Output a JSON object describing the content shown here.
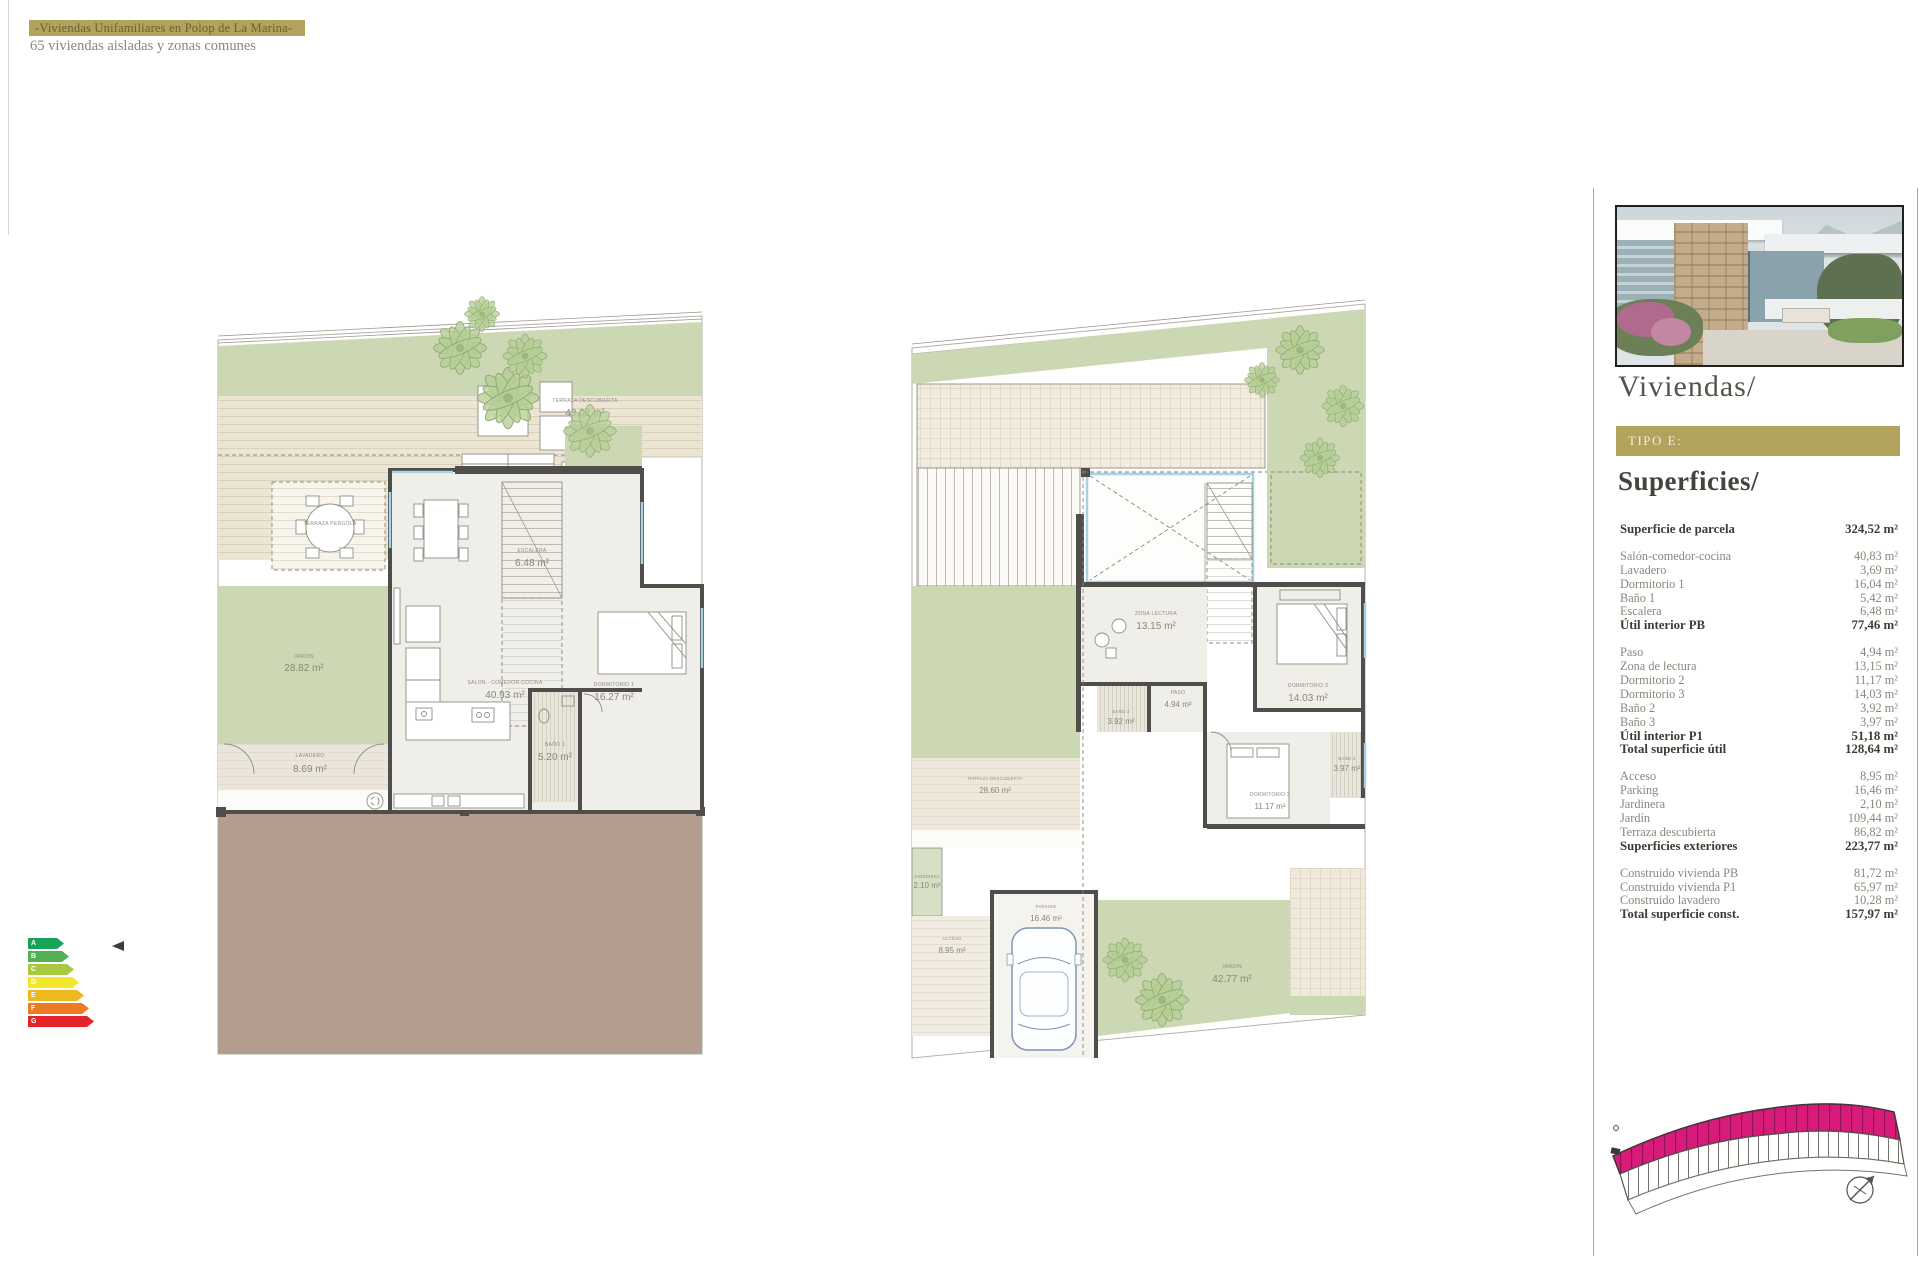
{
  "header": {
    "title": "-Viviendas Unifamiliares en Polop de La Marina-",
    "subtitle": "65 viviendas aisladas y zonas comunes"
  },
  "sidebar": {
    "project_title": "Viviendas/",
    "type_label": "TIPO E:",
    "section_title": "Superficies/"
  },
  "surfaces": {
    "sections": [
      {
        "rows": [
          {
            "label": "Superficie de parcela",
            "value": "324,52 m²",
            "bold": true
          }
        ]
      },
      {
        "rows": [
          {
            "label": "Salón-comedor-cocina",
            "value": "40,83 m²"
          },
          {
            "label": "Lavadero",
            "value": "3,69 m²"
          },
          {
            "label": "Dormitorio 1",
            "value": "16,04 m²"
          },
          {
            "label": "Baño 1",
            "value": "5,42 m²"
          },
          {
            "label": "Escalera",
            "value": "6,48 m²"
          },
          {
            "label": "Útil interior PB",
            "value": "77,46 m²",
            "bold": true
          }
        ]
      },
      {
        "rows": [
          {
            "label": "Paso",
            "value": "4,94 m²"
          },
          {
            "label": "Zona de lectura",
            "value": "13,15 m²"
          },
          {
            "label": "Dormitorio 2",
            "value": "11,17 m²"
          },
          {
            "label": "Dormitorio 3",
            "value": "14,03 m²"
          },
          {
            "label": "Baño 2",
            "value": "3,92 m²"
          },
          {
            "label": "Baño 3",
            "value": "3,97 m²"
          },
          {
            "label": "Útil interior P1",
            "value": "51,18 m²",
            "bold": true
          },
          {
            "label": "Total superficie útil",
            "value": "128,64 m²",
            "bold": true
          }
        ]
      },
      {
        "rows": [
          {
            "label": "Acceso",
            "value": "8,95 m²"
          },
          {
            "label": "Parking",
            "value": "16,46 m²"
          },
          {
            "label": "Jardinera",
            "value": "2,10 m²"
          },
          {
            "label": "Jardín",
            "value": "109,44 m²"
          },
          {
            "label": "Terraza descubierta",
            "value": "86,82 m²"
          },
          {
            "label": "Superficies exteriores",
            "value": "223,77 m²",
            "bold": true
          }
        ]
      },
      {
        "rows": [
          {
            "label": "Construido vivienda PB",
            "value": "81,72 m²"
          },
          {
            "label": "Construido vivienda P1",
            "value": "65,97 m²"
          },
          {
            "label": "Construido lavadero",
            "value": "10,28 m²"
          },
          {
            "label": "Total superficie const.",
            "value": "157,97 m²",
            "bold": true
          }
        ]
      }
    ]
  },
  "plan_pb": {
    "rooms": {
      "terraza": {
        "label": "TERRAZA DESCUBIERTA",
        "area": "43.02 m²"
      },
      "pergola": {
        "label": "TERRAZA PERGOLA"
      },
      "jardin_izq": {
        "label": "JARDIN",
        "area": "28.82 m²"
      },
      "jardin_der": {
        "label": "JARDIN",
        "area": "39.30 m²"
      },
      "lavadero": {
        "label": "LAVADERO",
        "area": "8.69 m²"
      },
      "salon": {
        "label": "SALON - COMEDOR-COCINA",
        "area": "40.93 m²"
      },
      "escalera": {
        "label": "ESCALERA",
        "area": "6.48 m²"
      },
      "dormitorio_1": {
        "label": "DORMITORIO 1",
        "area": "16.27 m²"
      },
      "bano_1": {
        "label": "BAÑO 1",
        "area": "5.20 m²"
      }
    }
  },
  "plan_p1": {
    "rooms": {
      "zona_lectura": {
        "label": "ZONA LECTURA",
        "area": "13.15 m²"
      },
      "paso": {
        "label": "PASO",
        "area": "4.94 m²"
      },
      "dormitorio_2": {
        "label": "DORMITORIO 2",
        "area": "11.17 m²"
      },
      "dormitorio_3": {
        "label": "DORMITORIO 3",
        "area": "14.03 m²"
      },
      "bano_2": {
        "label": "BAÑO 2",
        "area": "3.92 m²"
      },
      "bano_3": {
        "label": "BAÑO 3",
        "area": "3.97 m²"
      },
      "terraza": {
        "label": "TERRAZA DESCUBIERTA",
        "area": "28.60 m²"
      },
      "jardinera": {
        "label": "JARDINERA",
        "area": "2.10 m²"
      },
      "acceso": {
        "label": "ACCESO",
        "area": "8.95 m²"
      },
      "parking": {
        "label": "PARKING",
        "area": "16.46 m²"
      },
      "jardin": {
        "label": "JARDIN",
        "area": "42.77 m²"
      }
    }
  },
  "energy_scale": {
    "levels": [
      {
        "letter": "A",
        "color": "#18a357"
      },
      {
        "letter": "B",
        "color": "#52b153"
      },
      {
        "letter": "C",
        "color": "#a8c83e"
      },
      {
        "letter": "D",
        "color": "#f2e72c"
      },
      {
        "letter": "E",
        "color": "#f0b81f"
      },
      {
        "letter": "F",
        "color": "#ec7b23"
      },
      {
        "letter": "G",
        "color": "#e5242a"
      }
    ]
  },
  "site_map": {
    "highlight_color": "#d81b7a"
  }
}
